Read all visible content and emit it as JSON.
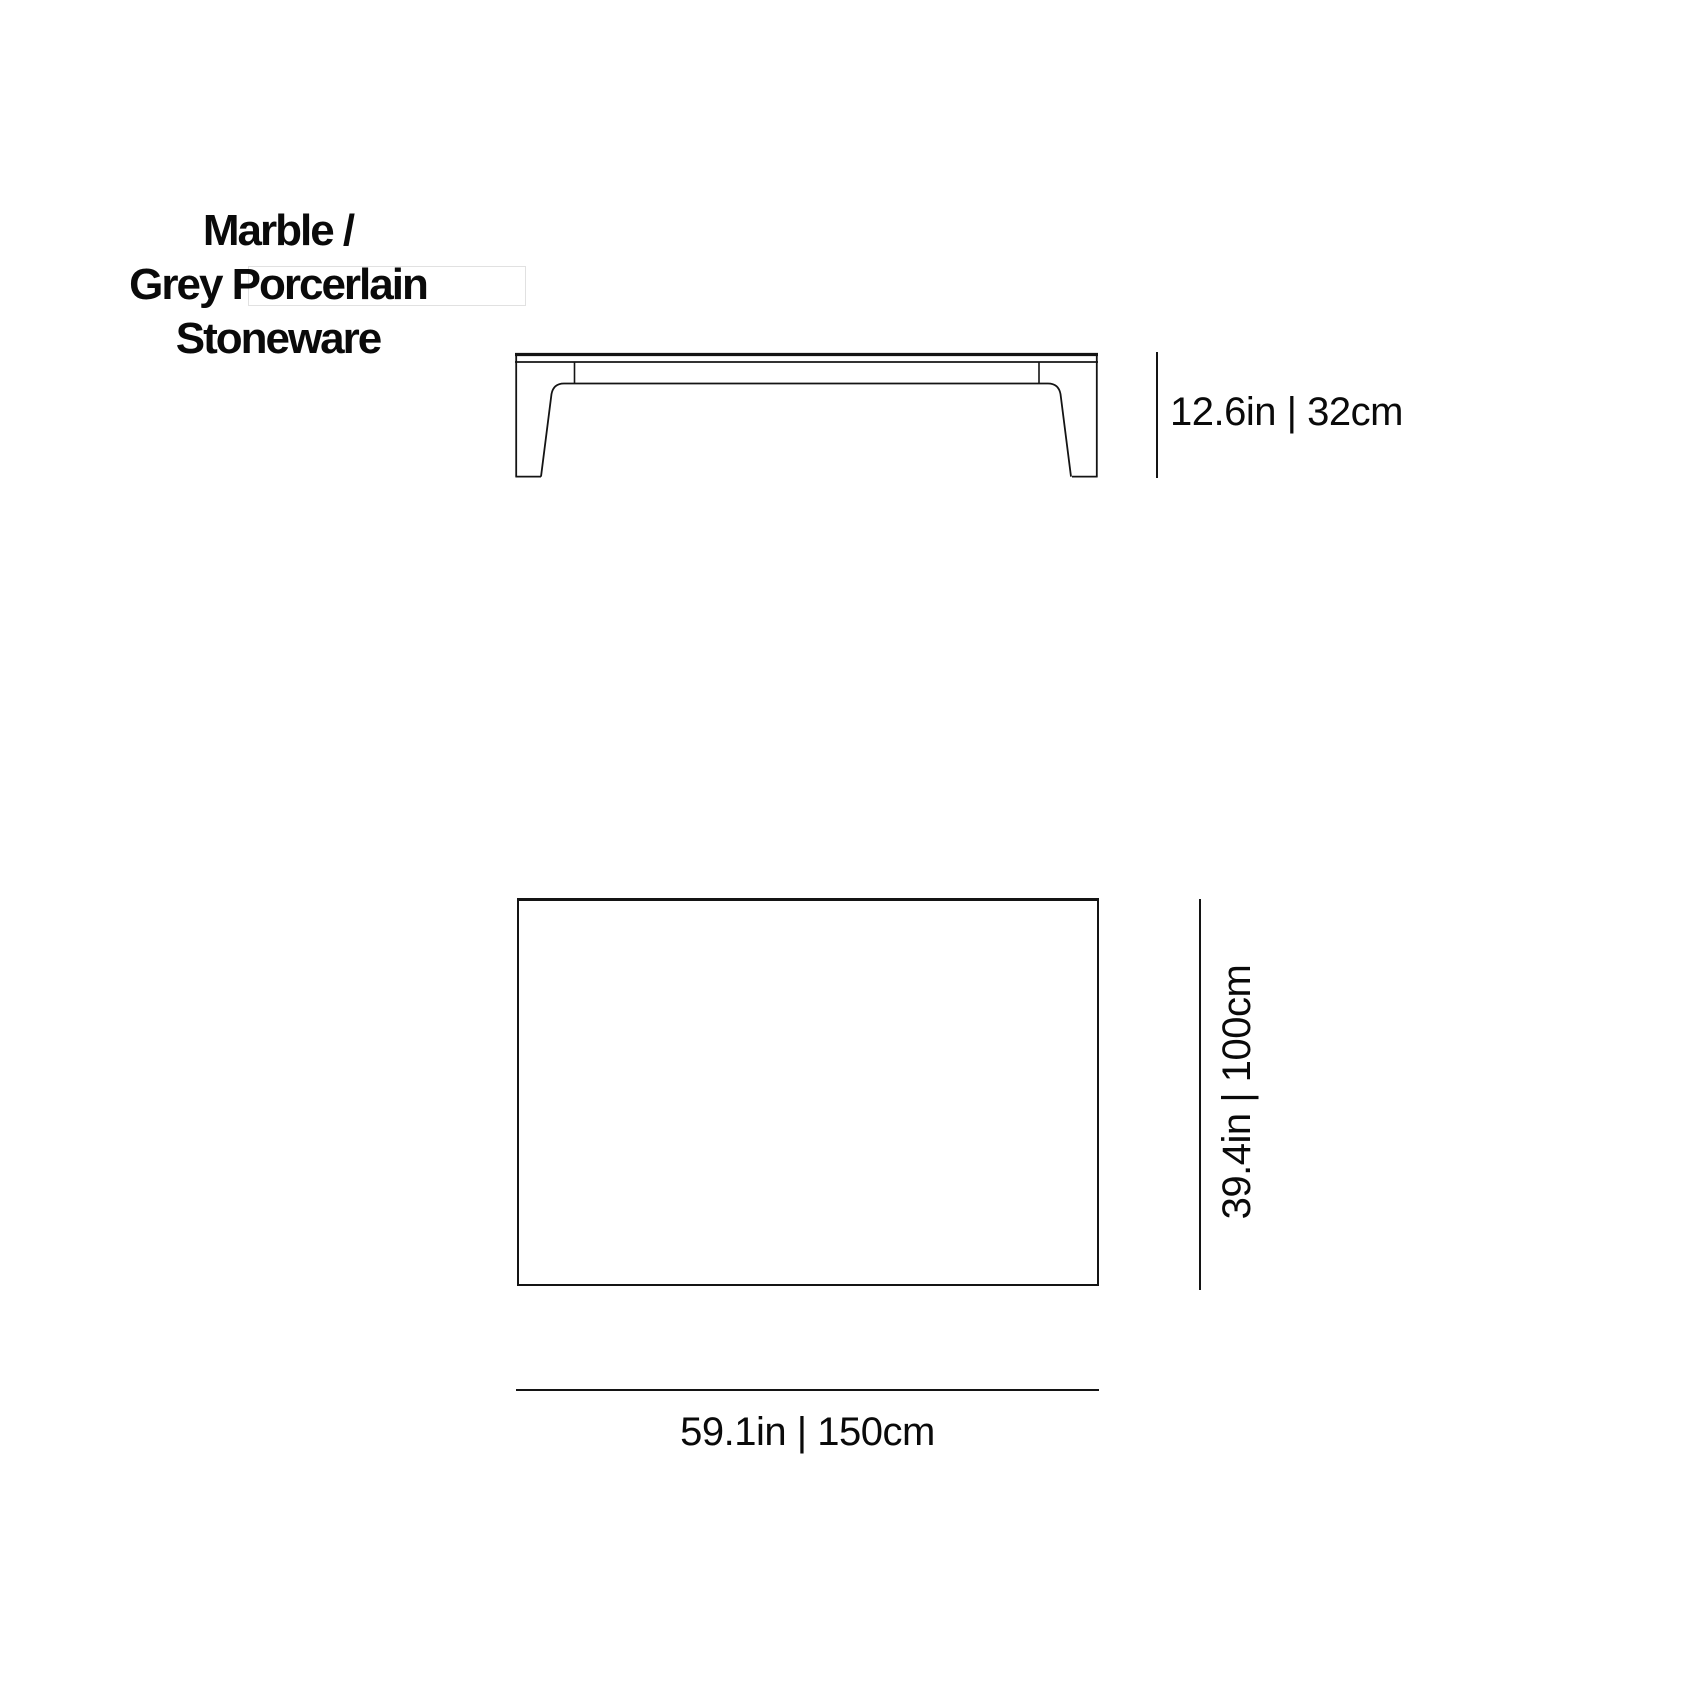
{
  "title": {
    "line1": "Marble /",
    "line2": "Grey Porcerlain Stoneware"
  },
  "front_view": {
    "name": "coffee-table-front-elevation",
    "height_label": "12.6in | 32cm"
  },
  "top_view": {
    "name": "coffee-table-top-view",
    "depth_label": "39.4in | 100cm",
    "width_label": "59.1in | 150cm"
  },
  "colors": {
    "line": "#141414",
    "text": "#0a0a0a",
    "faint_box": "#d9d9d9",
    "background": "#ffffff"
  }
}
